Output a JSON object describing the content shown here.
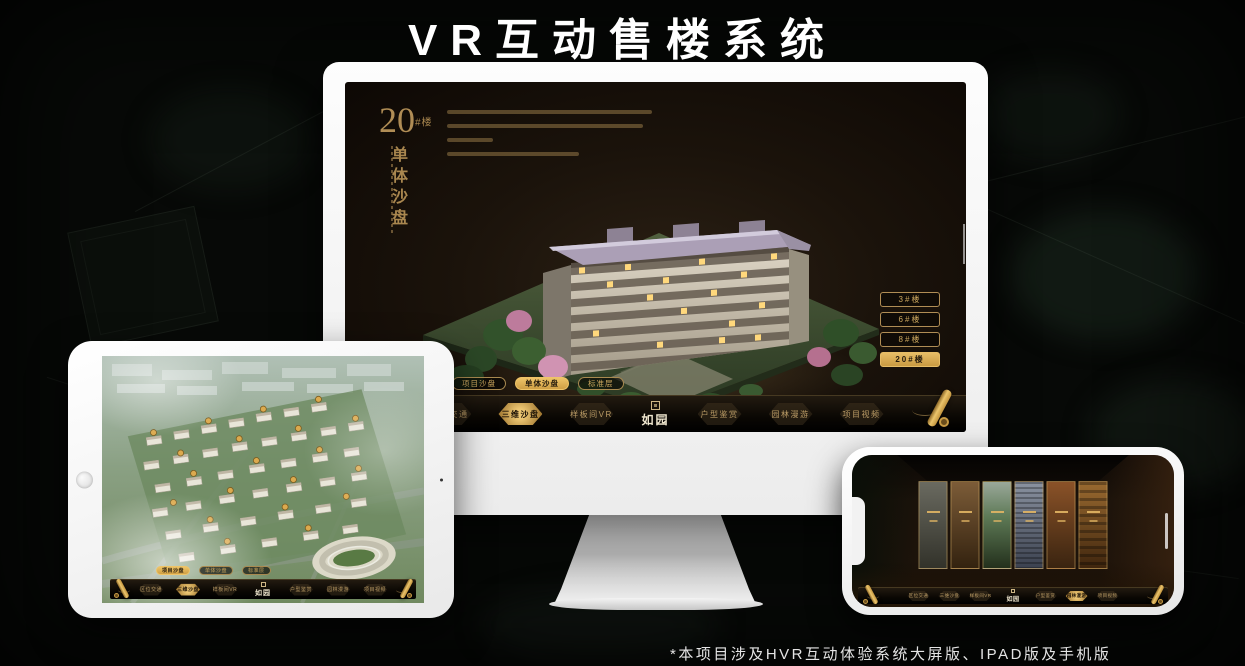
{
  "page": {
    "title": "VR互动售楼系统",
    "footnote": "*本项目涉及HVR互动体验系统大屏版、IPAD版及手机版"
  },
  "colors": {
    "gold": "#c9a361",
    "gold_active": "#d9ab55",
    "screen_bg": "#1b130b",
    "page_bg": "#070907",
    "device_white": "#f5f5f5"
  },
  "app": {
    "logo": "如园",
    "nav": {
      "items": [
        "区位交通",
        "三维沙盘",
        "样板间VR",
        "户型鉴赏",
        "园林漫游",
        "项目视频"
      ],
      "active_monitor": "三维沙盘",
      "active_ipad": "三维沙盘",
      "active_phone": "园林漫游"
    },
    "tabs": {
      "items": [
        "项目沙盘",
        "单体沙盘",
        "标准层"
      ],
      "active_monitor": "单体沙盘",
      "active_ipad": "项目沙盘"
    }
  },
  "monitor_app": {
    "heading": {
      "number": "20",
      "unit": "#楼",
      "subtitle": "单体沙盘"
    },
    "building_buttons": {
      "items": [
        "3#楼",
        "6#楼",
        "8#楼",
        "20#楼"
      ],
      "active": "20#楼"
    }
  }
}
